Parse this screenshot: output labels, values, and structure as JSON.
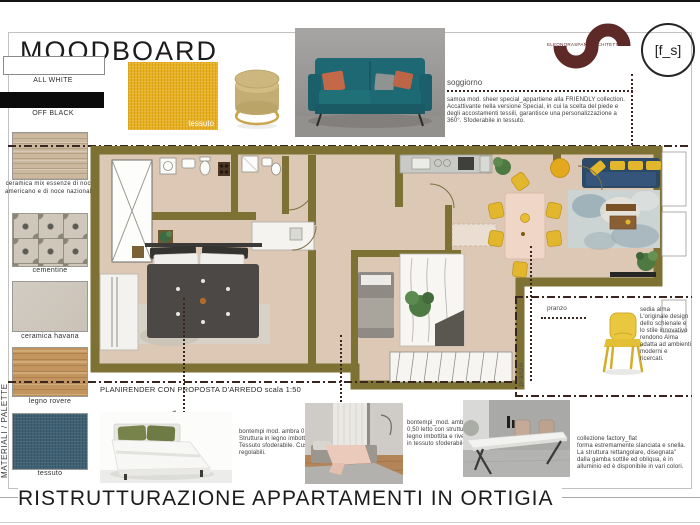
{
  "board": {
    "title": "MOODBOARD",
    "footer_title": "RISTRUTTURAZIONE APPARTAMENTI IN ORTIGIA",
    "side_label": "MATERIALI / PALETTE",
    "plan_caption": "PLANIRENDER CON PROPOSTA D'ARREDO scala 1:50"
  },
  "branding": {
    "studio": "ELEONORASPANOARCHITETTO",
    "badge": "[f_s]"
  },
  "materials": [
    {
      "name": "all-white",
      "label": "ALL WHITE",
      "color": "#ffffff"
    },
    {
      "name": "off-black",
      "label": "OFF BLACK",
      "color": "#0b0b0b"
    },
    {
      "name": "ceramica-mix",
      "label": "ceramica mix essenze di noce americano e di noce nazionale",
      "color": "#cbb89e"
    },
    {
      "name": "cementine",
      "label": "cementine",
      "color": "#cfc8ba"
    },
    {
      "name": "ceramica-havana",
      "label": "ceramica havana",
      "color": "#cdc6bc"
    },
    {
      "name": "legno-rovere",
      "label": "legno rovere",
      "color": "#c2955e"
    },
    {
      "name": "tessuto-blu",
      "label": "tessuto",
      "color": "#3e6174"
    }
  ],
  "top_products": {
    "fabric_label": "tessuto"
  },
  "annotations": {
    "soggiorno_label": "soggiorno",
    "soggiorno_text": "samoa mod. sheer special_appartiene alla FRIENDLY collection.\nAccattivante nella versione Special, in cui la scelta del piede e degli accostamenti tessili, garantisce una personalizzazione a 360°. Sfoderabile in tessuto.",
    "camera_label": "camera",
    "pranzo_label": "pranzo",
    "bed1_text": "bontempi mod. ambra 0,50.\nStruttura in legno imbottita. Tessuto sfoderabile. Cuscini regolabili.",
    "bed2_text": "bontempi_mod. ambra 0,50 letto con struttura in legno imbottita e rivestita in tessuto sfoderabile.",
    "chair_text": "sedia alma\nL'originale design dello schienale e lo stile innovativo rendono Alma adatta ad ambienti moderni e ricercati.",
    "table_text": "collezione factory_flat\nforma estremamente slanciata e snella. La struttura rettangolare, disegnata\" dalla gamba sottile ed obliqua, è in alluminio ed è disponibile in vari colori."
  },
  "palette_colors": {
    "wall_olive": "#7d7233",
    "floor_beige": "#dcc8b5",
    "accent_yellow": "#e3b72d",
    "sofa_navy": "#2c4a66",
    "logo_maroon": "#5e2a28",
    "dotted_line": "#38261f"
  }
}
